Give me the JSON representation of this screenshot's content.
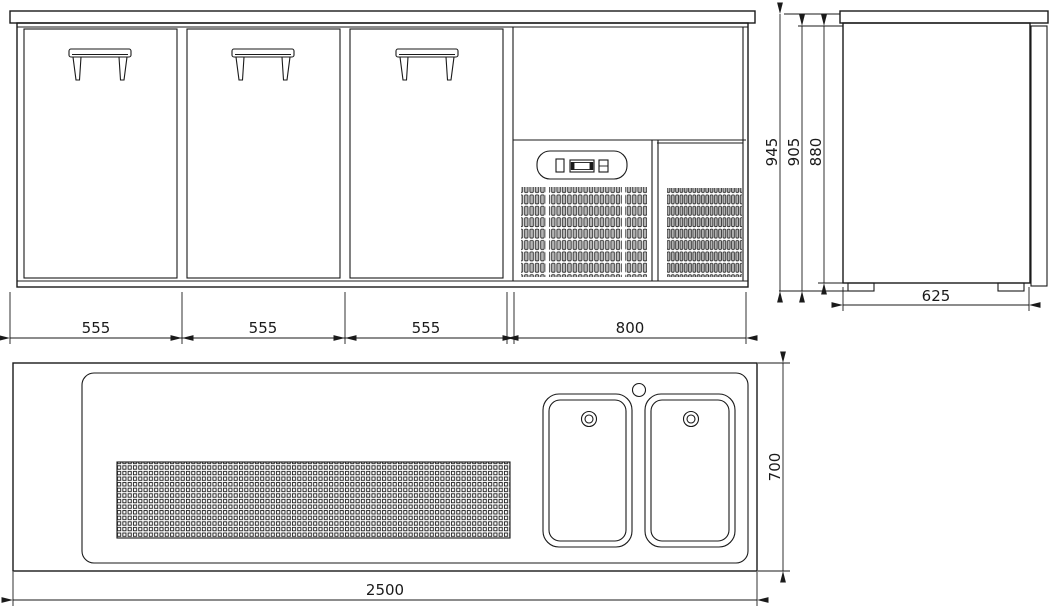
{
  "drawing": {
    "background": "#ffffff",
    "line_color": "#1a1a1a",
    "views": {
      "front": {
        "dim_door_1": "555",
        "dim_door_2": "555",
        "dim_door_3": "555",
        "dim_cooling_unit": "800"
      },
      "side": {
        "dim_total_height": "945",
        "dim_height_with_feet": "905",
        "dim_body_height": "880",
        "dim_depth": "625"
      },
      "plan": {
        "dim_total_width": "2500",
        "dim_total_depth": "700"
      }
    }
  }
}
